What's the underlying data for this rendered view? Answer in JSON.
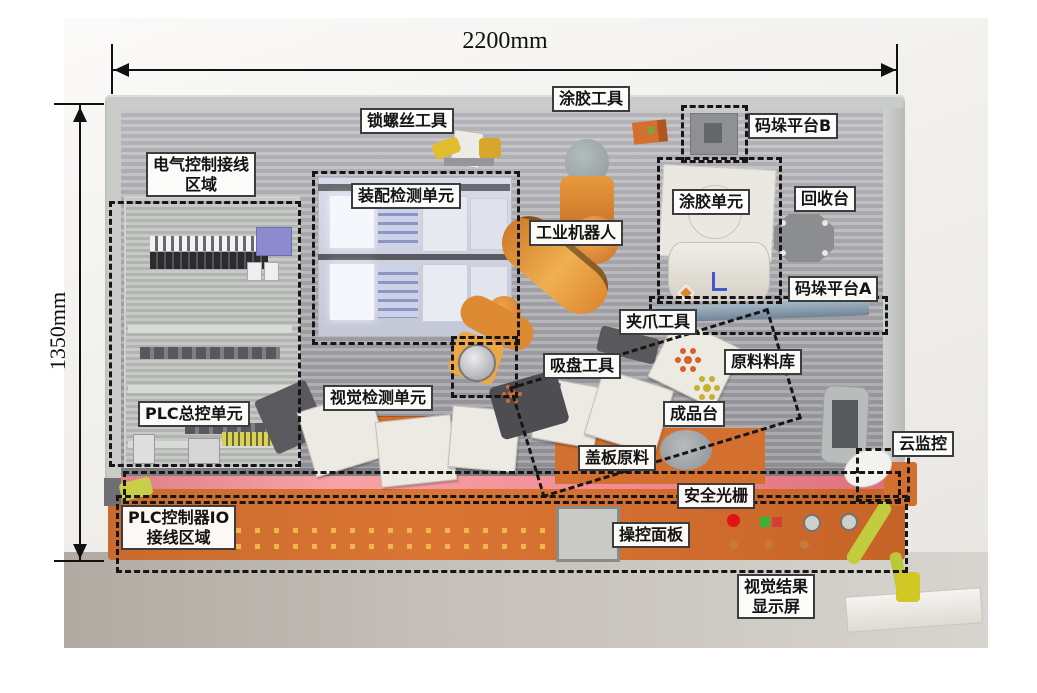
{
  "diagram": {
    "type": "labeled-equipment-diagram",
    "subject": "industrial robot training workbench",
    "dimensions": {
      "width_label": "2200mm",
      "height_label": "1350mm"
    },
    "labels": {
      "lock_screw_tool": "锁螺丝工具",
      "glue_tool": "涂胶工具",
      "pallet_platform_b": "码垛平台B",
      "electrical_wiring_area_line1": "电气控制接线",
      "electrical_wiring_area_line2": "区域",
      "assembly_inspection_unit": "装配检测单元",
      "industrial_robot": "工业机器人",
      "glue_unit": "涂胶单元",
      "recycle_table": "回收台",
      "pallet_platform_a": "码垛平台A",
      "gripper_tool": "夹爪工具",
      "suction_tool": "吸盘工具",
      "raw_material_store": "原料料库",
      "plc_master_unit": "PLC总控单元",
      "vision_inspection_unit": "视觉检测单元",
      "finished_product_table": "成品台",
      "cover_plate_material": "盖板原料",
      "cloud_monitor": "云监控",
      "safety_light_curtain": "安全光栅",
      "plc_io_area_line1": "PLC控制器IO",
      "plc_io_area_line2": "接线区域",
      "control_panel": "操控面板",
      "vision_result_display_line1": "视觉结果",
      "vision_result_display_line2": "显示屏"
    },
    "colors": {
      "bench_orange": "#d4702f",
      "robot_orange": "#e09134",
      "wall_gray": "#9c9ca2",
      "frame_gray": "#c9ccc9",
      "light_curtain_pink": "#f08a91",
      "pallet_bar_blue": "#8ba2b4",
      "label_border": "#3d3d3d",
      "dashed_outline": "#161616"
    }
  }
}
